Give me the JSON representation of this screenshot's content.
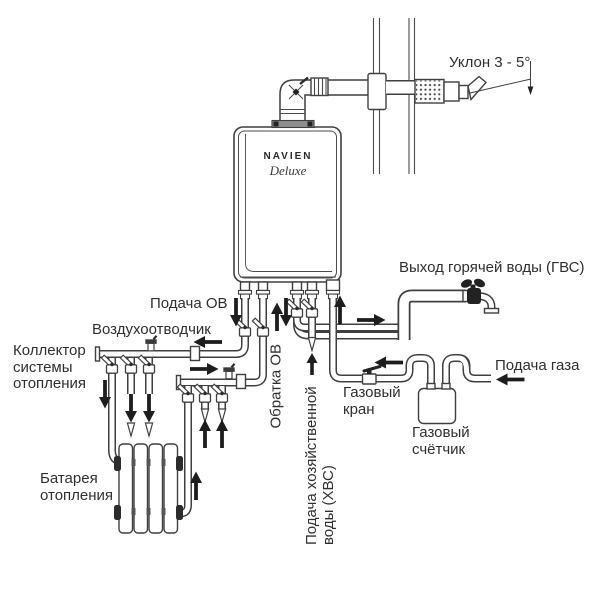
{
  "diagram": {
    "boiler": {
      "brand": "NAVIEN",
      "model": "Deluxe"
    },
    "labels": {
      "slope": "Уклон 3 - 5°",
      "dhw_out": "Выход горячей воды (ГВС)",
      "ch_supply": "Подача ОВ",
      "air_vent": "Воздухоотводчик",
      "manifold": "Коллектор\nсистемы\nотопления",
      "ch_return": "Обратка ОВ",
      "radiator": "Батарея\nотопления",
      "cold_water": "Подача хозяйственной\nводы (ХВС)",
      "gas_valve": "Газовый\nкран",
      "gas_meter": "Газовый\nсчётчик",
      "gas_supply": "Подача газа"
    }
  }
}
